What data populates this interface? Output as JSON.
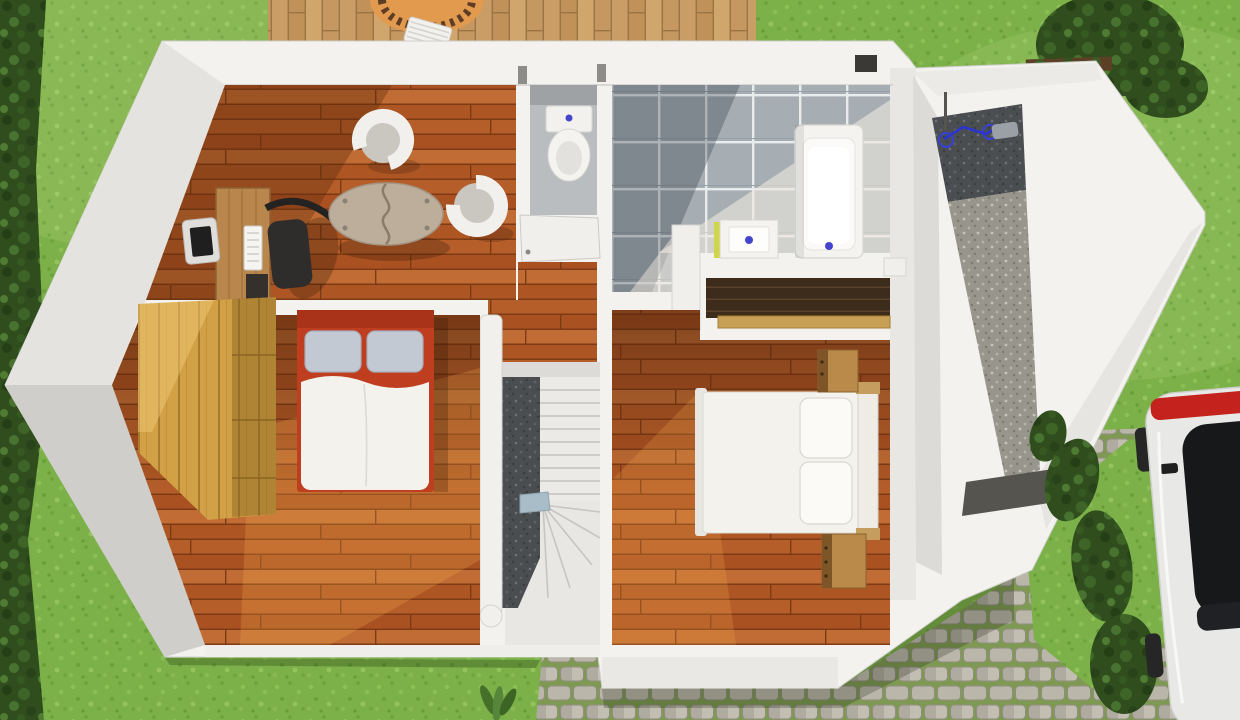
{
  "meta": {
    "type": "architectural-3d-floor-plan-render",
    "view": "top-down",
    "description": "3D rendered upper-floor plan of a house set in a lawn with deck, driveway and parked car"
  },
  "palette": {
    "grass": "#7cb049",
    "foliage": "#2f4d1d",
    "wall": "#f3f2ef",
    "wallFaceLight": "#e4e3e0",
    "wallFaceDark": "#cfcecb",
    "woodFloor": "#b65e2a",
    "tile": "#a6aeb4",
    "wcFloor": "#b9bdbf",
    "stairDark": "#4b4e51",
    "stairLight": "#eceae6",
    "wardrobeWood": "#d2a045",
    "bedFrameRed": "#bf3e1f",
    "bedHeadboardRed": "#a93318",
    "pillowGray": "#c3c9d3",
    "duvetWhite": "#f4f2ed",
    "deskWood": "#b9864d",
    "chairDark": "#2e2d2b",
    "tableTop": "#bcae9a",
    "tubChairRim": "#f2f0ed",
    "tubChairSeat": "#cac7c1",
    "toiletWhite": "#f2f1ee",
    "bathtubWhite": "#f4f3f0",
    "sinkAccent": "#cfd64a",
    "drainBlue": "#4444cc",
    "closetInterior": "#3d2b1b",
    "shelfPlank": "#c8a055",
    "nightstandWood": "#b98a4a",
    "gravelLight": "#97958c",
    "bikeBlue": "#2a35d0",
    "matDark": "#55544f",
    "cobbleStone": "#bab6aa",
    "cobbleMoss": "#7e9a52",
    "deckWood": "#c99d65",
    "parasolOrange": "#e29b4e",
    "parasolFringe": "#5d3d26",
    "carBody": "#e8e8e6",
    "carGlass": "#17181a",
    "carTail": "#c4231d",
    "ventDark": "#3a3936",
    "metalStep": "#a9bdc9"
  },
  "exterior": {
    "features": [
      "lawn",
      "tree-line-west",
      "hedge-northeast",
      "wooden-deck",
      "orange-parasol",
      "striped-lounger",
      "cobblestone-driveway",
      "garden-shrubs",
      "grass-patch-east",
      "white-car",
      "entrance-mat",
      "gravel-side-yard",
      "bicycle",
      "garden-plant"
    ]
  },
  "rooms": [
    {
      "id": "living-office",
      "floor": "hardwood",
      "furniture": [
        "computer-desk",
        "monitor",
        "office-chair",
        "oval-split-table",
        "tub-chair",
        "tub-chair"
      ]
    },
    {
      "id": "wc",
      "floor": "stone-gray",
      "furniture": [
        "toilet",
        "door"
      ]
    },
    {
      "id": "bathroom",
      "floor": "blue-gray-tile",
      "furniture": [
        "bathtub",
        "washbasin"
      ]
    },
    {
      "id": "bedroom-west",
      "floor": "hardwood",
      "furniture": [
        "double-bed-red-frame",
        "pine-wardrobe"
      ]
    },
    {
      "id": "bedroom-east",
      "floor": "hardwood",
      "furniture": [
        "double-bed-white",
        "nightstand",
        "nightstand",
        "open-closet-shelf"
      ]
    },
    {
      "id": "stair-hall",
      "floor": "hardwood",
      "furniture": [
        "winder-staircase",
        "stair-railing"
      ]
    },
    {
      "id": "annex",
      "floor": "gravel",
      "furniture": [
        "bicycle",
        "entrance-mat"
      ]
    }
  ]
}
